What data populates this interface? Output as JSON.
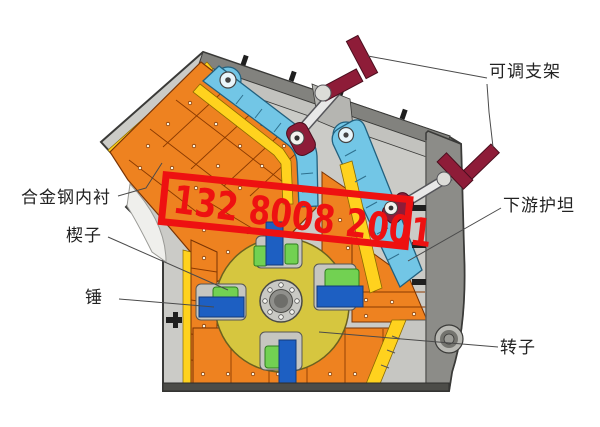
{
  "watermark": {
    "text": "132 8008 2001",
    "color": "#ee1111"
  },
  "labels": {
    "adjustable_bracket": "可调支架",
    "downstream_apron": "下游护坦",
    "alloy_steel_liner": "合金钢内衬",
    "wedge": "楔子",
    "hammer": "锤",
    "rotor": "转子"
  },
  "colors": {
    "background": "#ffffff",
    "casing_light": "#cbcbc7",
    "casing_panel": "#c2c2be",
    "casing_dark": "#8c8c88",
    "liner_orange": "#ee8220",
    "liner_joint": "#8b3a00",
    "edge_yellow": "#ffd21e",
    "impact_plate_cyan": "#72c6e6",
    "rotor_olive": "#d6c63f",
    "hammer_blue": "#1d5fc2",
    "wedge_green": "#72d152",
    "adjuster_maroon": "#8e1c38",
    "watermark_red": "#ee1111",
    "label_text": "#222222"
  }
}
